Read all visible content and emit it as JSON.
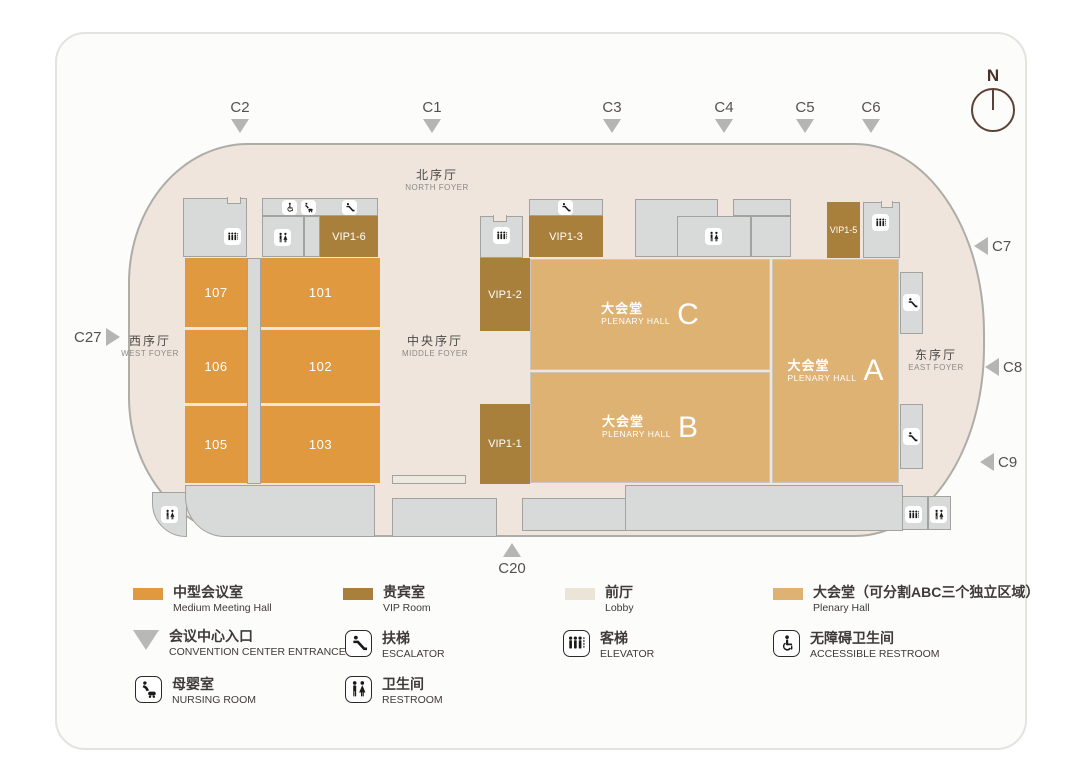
{
  "compass": {
    "north_label": "N"
  },
  "entrances": {
    "c1": "C1",
    "c2": "C2",
    "c3": "C3",
    "c4": "C4",
    "c5": "C5",
    "c6": "C6",
    "c7": "C7",
    "c8": "C8",
    "c9": "C9",
    "c20": "C20",
    "c27": "C27"
  },
  "foyers": {
    "north": {
      "zh": "北序厅",
      "en": "NORTH FOYER"
    },
    "west": {
      "zh": "西序厅",
      "en": "WEST FOYER"
    },
    "middle": {
      "zh": "中央序厅",
      "en": "MIDDLE FOYER"
    },
    "east": {
      "zh": "东序厅",
      "en": "EAST FOYER"
    }
  },
  "meeting_rooms": {
    "r101": "101",
    "r102": "102",
    "r103": "103",
    "r105": "105",
    "r106": "106",
    "r107": "107"
  },
  "vip_rooms": {
    "v1": "VIP1-1",
    "v2": "VIP1-2",
    "v3": "VIP1-3",
    "v5": "VIP1-5",
    "v6": "VIP1-6"
  },
  "plenary_halls": {
    "zh": "大会堂",
    "en": "PLENARY HALL",
    "a": "A",
    "b": "B",
    "c": "C"
  },
  "legend": {
    "medium_meeting_hall": {
      "zh": "中型会议室",
      "en": "Medium Meeting Hall",
      "color": "#E0993F"
    },
    "vip_room": {
      "zh": "贵宾室",
      "en": "VIP Room",
      "color": "#A8803C"
    },
    "lobby": {
      "zh": "前厅",
      "en": "Lobby",
      "color": "#EDE4D8"
    },
    "plenary_hall": {
      "zh": "大会堂（可分割ABC三个独立区域）",
      "en": "Plenary Hall",
      "color": "#DDB273"
    },
    "entrance": {
      "zh": "会议中心入口",
      "en": "CONVENTION CENTER ENTRANCE"
    },
    "escalator": {
      "zh": "扶梯",
      "en": "ESCALATOR"
    },
    "elevator": {
      "zh": "客梯",
      "en": "ELEVATOR"
    },
    "accessible_restroom": {
      "zh": "无障碍卫生间",
      "en": "ACCESSIBLE RESTROOM"
    },
    "nursing_room": {
      "zh": "母婴室",
      "en": "NURSING ROOM"
    },
    "restroom": {
      "zh": "卫生间",
      "en": "RESTROOM"
    }
  }
}
